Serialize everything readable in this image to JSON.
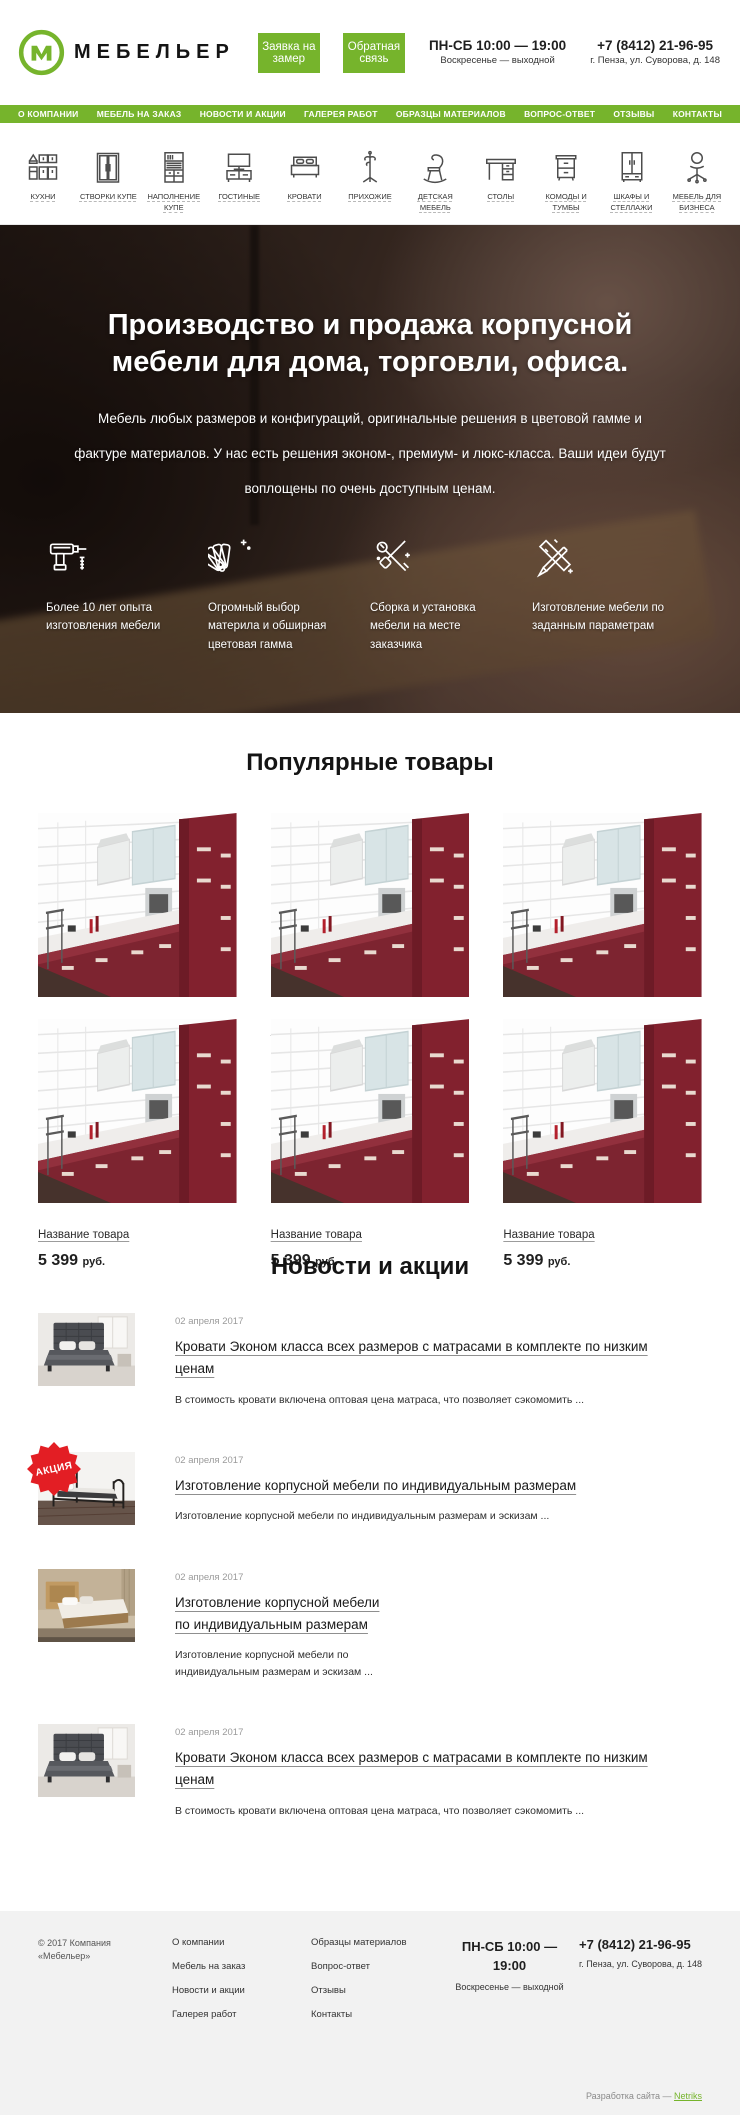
{
  "colors": {
    "accent": "#76b42c",
    "badge_red": "#e31e24",
    "text_dark": "#1f1f1f",
    "text_gray": "#9b9b9b",
    "footer_bg": "#f2f2f2",
    "kitchen_red": "#7d2430"
  },
  "header": {
    "brand": "МЕБЕЛЬЕР",
    "measure_button_label": "Заявка на замер",
    "feedback_button_label": "Обратная связь",
    "hours_line1": "ПН-СБ 10:00 — 19:00",
    "hours_line2": "Воскресенье — выходной",
    "phone": "+7 (8412) 21-96-95",
    "address": "г. Пенза, ул. Суворова, д. 148"
  },
  "nav": {
    "items": [
      "О КОМПАНИИ",
      "МЕБЕЛЬ НА ЗАКАЗ",
      "НОВОСТИ И АКЦИИ",
      "ГАЛЕРЕЯ РАБОТ",
      "ОБРАЗЦЫ МАТЕРИАЛОВ",
      "ВОПРОС-ОТВЕТ",
      "ОТЗЫВЫ",
      "КОНТАКТЫ"
    ]
  },
  "categories": {
    "items": [
      {
        "label": "Кухни",
        "icon": "kitchen-icon"
      },
      {
        "label": "Створки купе",
        "icon": "sliding-doors-icon"
      },
      {
        "label": "Наполнение купе",
        "icon": "wardrobe-filling-icon"
      },
      {
        "label": "Гостиные",
        "icon": "living-room-icon"
      },
      {
        "label": "Кровати",
        "icon": "bed-icon"
      },
      {
        "label": "Прихожие",
        "icon": "coat-rack-icon"
      },
      {
        "label": "Детская мебель",
        "icon": "kids-furniture-icon"
      },
      {
        "label": "Столы",
        "icon": "desk-icon"
      },
      {
        "label": "Комоды и тумбы",
        "icon": "dresser-icon"
      },
      {
        "label": "Шкафы и стеллажи",
        "icon": "cabinet-icon"
      },
      {
        "label": "Мебель для бизнеса",
        "icon": "office-chair-icon"
      }
    ]
  },
  "hero": {
    "title": "Производство и продажа корпусной мебели для дома, торговли, офиса.",
    "subtitle": "Мебель любых размеров и конфигураций, оригинальные решения в цветовой гамме и фактуре материалов. У нас есть решения эконом-, премиум- и люкс-класса. Ваши идеи будут воплощены по очень доступным ценам.",
    "features": [
      {
        "icon": "drill-icon",
        "text": "Более 10 лет опыта изготовления мебели"
      },
      {
        "icon": "swatches-icon",
        "text": "Огромный выбор материла и обширная цветовая гамма"
      },
      {
        "icon": "tools-icon",
        "text": "Сборка и установка мебели на месте заказчика"
      },
      {
        "icon": "drafting-icon",
        "text": "Изготовление мебели по заданным параметрам"
      }
    ]
  },
  "products": {
    "title": "Популярные товары",
    "items": [
      {
        "name": "Название товара",
        "price": "5 399",
        "currency": "руб."
      },
      {
        "name": "Название товара",
        "price": "5 399",
        "currency": "руб."
      },
      {
        "name": "Название товара",
        "price": "5 399",
        "currency": "руб."
      },
      {
        "name": "Название товара",
        "price": "5 399",
        "currency": "руб."
      },
      {
        "name": "Название товара",
        "price": "5 399",
        "currency": "руб."
      },
      {
        "name": "Название товара",
        "price": "5 399",
        "currency": "руб."
      }
    ]
  },
  "news": {
    "title": "Новости и акции",
    "badge": "АКЦИЯ",
    "items": [
      {
        "date": "02 апреля 2017",
        "title": "Кровати Эконом класса всех размеров с матрасами в комплекте по низким ценам",
        "excerpt": "В стоимость кровати включена оптовая цена матраса, что позволяет сэкомомить ...",
        "image": "bed-dark",
        "badge": false
      },
      {
        "date": "02 апреля 2017",
        "title": "Изготовление корпусной мебели по индивидуальным размерам",
        "excerpt": "Изготовление корпусной мебели по индивидуальным размерам и эскизам ...",
        "image": "bed-metal",
        "badge": true
      },
      {
        "date": "02 апреля 2017",
        "title": "Изготовление корпусной мебели по индивидуальным размерам",
        "excerpt": "Изготовление корпусной мебели по индивидуальным размерам и эскизам ...",
        "image": "bed-wood",
        "badge": false,
        "narrow": true
      },
      {
        "date": "02 апреля 2017",
        "title": "Кровати Эконом класса всех размеров с матрасами в комплекте по низким ценам",
        "excerpt": "В стоимость кровати включена оптовая цена матраса, что позволяет сэкомомить ...",
        "image": "bed-dark",
        "badge": false
      }
    ]
  },
  "footer": {
    "copyright": "© 2017 Компания «Мебельер»",
    "links_col1": [
      "О компании",
      "Мебель на заказ",
      "Новости и акции",
      "Галерея работ"
    ],
    "links_col2": [
      "Образцы материалов",
      "Вопрос-ответ",
      "Отзывы",
      "Контакты"
    ],
    "hours_line1": "ПН-СБ 10:00 —",
    "hours_line2": "19:00",
    "hours_line3": "Воскресенье — выходной",
    "phone": "+7 (8412) 21-96-95",
    "address": "г. Пенза, ул. Суворова, д. 148",
    "credits_prefix": "Разработка сайта — ",
    "credits_link": "Netriks"
  }
}
